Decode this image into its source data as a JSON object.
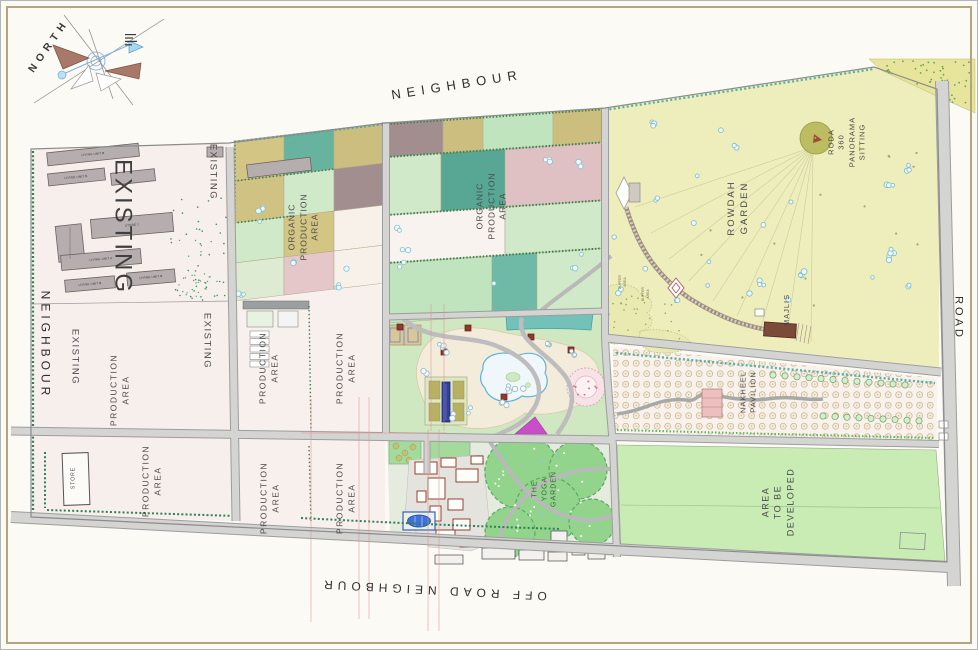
{
  "edge_labels": {
    "top": "NEIGHBOUR",
    "left": "NEIGHBOUR",
    "right": "ROAD",
    "bottom": "OFF ROAD NEIGHBOUR"
  },
  "compass": {
    "north": "NORTH"
  },
  "area_labels": {
    "existing": "EXISTING",
    "production_area": "PRODUCTION\nAREA",
    "organic_production_area": "ORGANIC\nPRODUCTION\nAREA",
    "rowdah_garden": "ROWDAH\nGARDEN",
    "roda_panorama_sitting": "RODA\n360\nPANORAMA\nSITTING",
    "majlis": "MAJLIS",
    "nakheel_pavilion": "NAKHEEL\nPAVILION",
    "the_yoga_garden": "THE\nYOGA\nGARDEN",
    "area_to_be_developed": "AREA\nTO BE\nDEVELOPED",
    "buffer_area": "BUFFER\nAREA",
    "store": "STORE"
  },
  "building_labels": {
    "living_unit_a": "LIVING UNIT A",
    "living_unit_b": "LIVING UNIT B",
    "store_1": "STORE 1"
  },
  "palette": {
    "frame": "#b3a57e",
    "background": "#fcfaf5",
    "existing_production_area": "#f7efec",
    "rowdah_garden": "#eeedbc",
    "park_green": "#cfe8c2",
    "yoga_green": "#92d48c",
    "area_to_be_developed": "#c9ecb4",
    "nakheel_ground": "#f8f1ec",
    "road": "#d2d2d0",
    "water": "#5fb2dd",
    "pool": "#3f72d9",
    "organic_khaki": "#d3c584",
    "organic_teal": "#68b2a0",
    "organic_green": "#d0e9c8",
    "organic_mauve": "#a28e8e",
    "organic_pink": "#e5c7ca",
    "accent_red": "#8a2f23"
  }
}
